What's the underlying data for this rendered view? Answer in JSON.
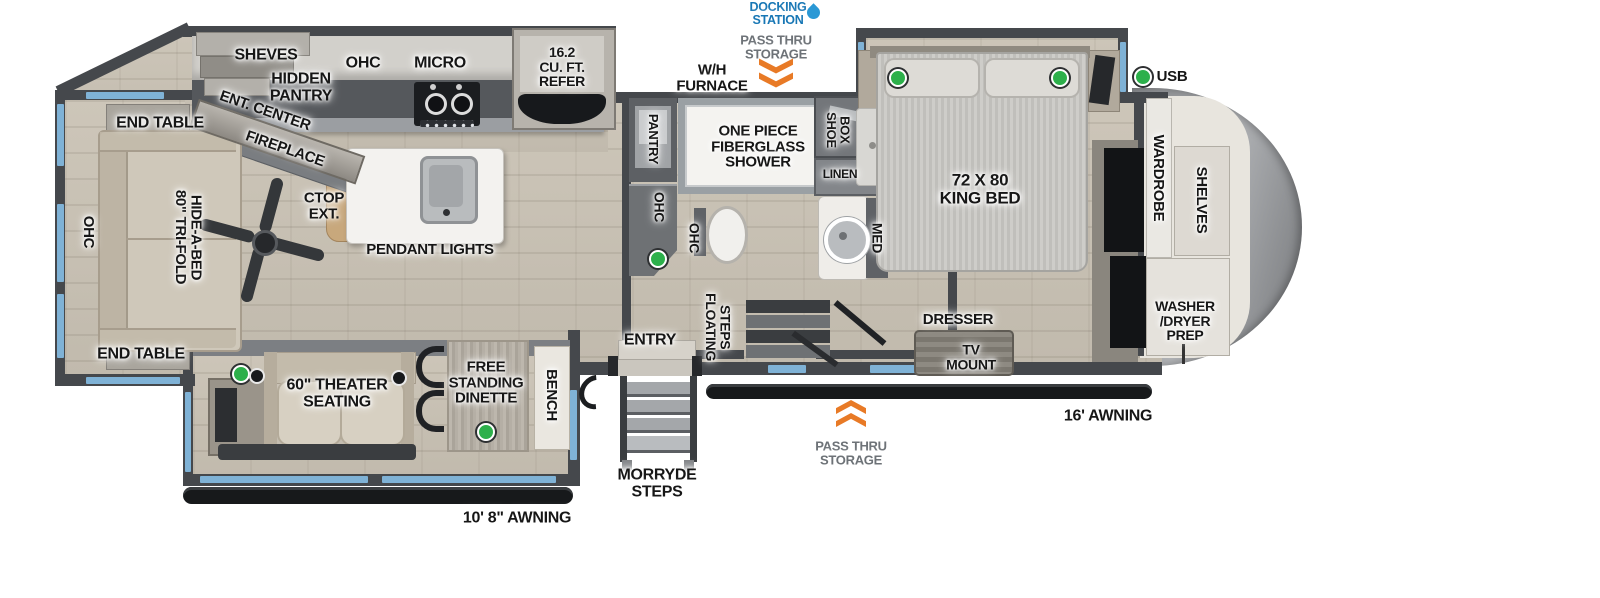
{
  "colors": {
    "wall": "#45484c",
    "window_blue": "#7fb2d6",
    "accent_orange": "#e87a26",
    "docking_blue": "#1877b5",
    "passthru_gray": "#6d7277",
    "led_green": "#2db04b",
    "floor_wood": "#c7c0b3",
    "awning_black": "#17191b"
  },
  "labels": {
    "rear": {
      "shelves": "SHEVES",
      "hidden_pantry": "HIDDEN\nPANTRY",
      "ent_center": "ENT. CENTER",
      "fireplace": "FIREPLACE",
      "end_table_top": "END TABLE",
      "end_table_bottom": "END TABLE",
      "ohc": "OHC",
      "hide_a_bed": "80\" TRI-FOLD\nHIDE-A-BED"
    },
    "kitchen": {
      "ohc": "OHC",
      "micro": "MICRO",
      "refer": "16.2\nCU. FT.\nREFER",
      "ctop_ext": "CTOP\nEXT.",
      "pendant_lights": "PENDANT LIGHTS",
      "pantry": "PANTRY",
      "counter_ohc": "OHC"
    },
    "utility": {
      "wh_furnace": "W/H\nFURNACE",
      "docking_station": "DOCKING\nSTATION",
      "pass_thru_top": "PASS THRU\nSTORAGE",
      "pass_thru_bottom": "PASS THRU\nSTORAGE"
    },
    "bath": {
      "shower": "ONE PIECE\nFIBERGLASS\nSHOWER",
      "toilet_ohc": "OHC",
      "shoe_box": "SHOE\nBOX",
      "linen": "LINEN",
      "med": "MED"
    },
    "bedroom": {
      "king_bed": "72 X 80\nKING BED",
      "usb": "USB",
      "dresser": "DRESSER",
      "tv_mount": "TV\nMOUNT",
      "wardrobe": "WARDROBE",
      "shelves": "SHELVES",
      "washer_dryer": "WASHER\n/DRYER\nPREP"
    },
    "entry": {
      "entry": "ENTRY",
      "floating_steps": "FLOATING\nSTEPS",
      "morryde_steps": "MORRYDE\nSTEPS"
    },
    "slide": {
      "theater": "60\" THEATER\nSEATING",
      "dinette": "FREE\nSTANDING\nDINETTE",
      "bench": "BENCH"
    },
    "awnings": {
      "front": "16' AWNING",
      "rear": "10' 8\" AWNING"
    }
  }
}
